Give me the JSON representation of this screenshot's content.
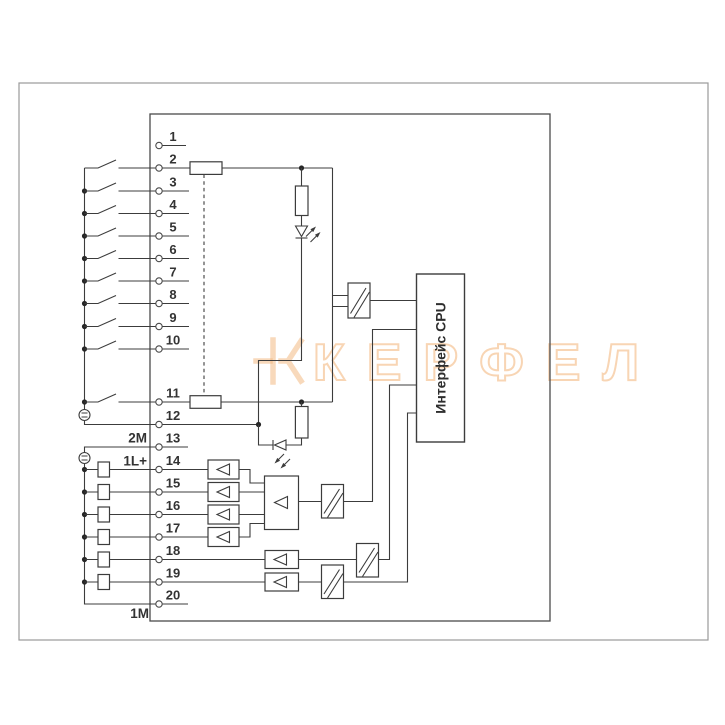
{
  "diagram": {
    "terminals": [
      "1",
      "2",
      "3",
      "4",
      "5",
      "6",
      "7",
      "8",
      "9",
      "10",
      "11",
      "12",
      "13",
      "14",
      "15",
      "16",
      "17",
      "18",
      "19",
      "20"
    ],
    "labels": {
      "common_2m": "2M",
      "supply_1l": "1L+",
      "common_1m": "1M"
    },
    "cpu_box": {
      "label": "Интерфейс CPU"
    },
    "watermark": {
      "text": "КЕРФЕЛ"
    },
    "colors": {
      "line": "#3c3c3c",
      "module_border": "#4a4a4a",
      "outer_border": "#9a9a9a",
      "watermark": "#f2b377",
      "background": "#ffffff"
    }
  }
}
